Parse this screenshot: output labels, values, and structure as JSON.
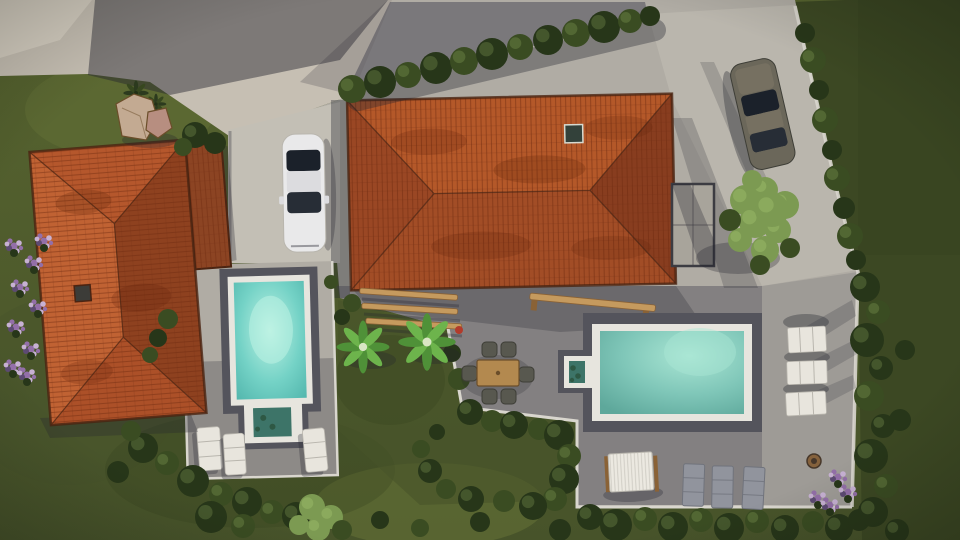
{
  "title": "aerial-render-villa-property",
  "scene_inventory": [
    "left villa with terracotta hip roof and chimney",
    "main villa with large terracotta hip roof and skylight",
    "white car on carport slab",
    "dark car parked near boundary wall",
    "small pool with step entry and three white loungers",
    "large pool with step entry, white loungers, gray loungers, canopy daybed",
    "pergola beams, outdoor dining table with six chairs, two palm trees",
    "hedge row, boundary wall with shrubs, lawns, rocks, purple flowers, fire pit"
  ],
  "palette": {
    "lawn_base": "#57642f",
    "lawn_dark": "#47532a",
    "lawn_light": "#6d7a3a",
    "lawn_shadow": "#36421f",
    "lawn_right": "#3c4823",
    "tree_dark": "#273619",
    "tree_mid": "#3a4c22",
    "tree_light": "#7c9a52",
    "tree_highlight": "#9ab968",
    "rock_ground": "#c6bfb3",
    "rock_lit": "#d8d1c4",
    "rock_big": "#c3aa92",
    "rock_small": "#b78e80",
    "pave_light": "#b0aca4",
    "pave_lit": "#c3bfb5",
    "curb_white": "#d9d6ce",
    "shadow": "#23242f",
    "terrace_shadow": "#3a3a4a",
    "roof_top": "#b45829",
    "roof_bottom": "#a24d26",
    "roof_west": "#9a4724",
    "roof_east": "#883d1f",
    "lroof_west": "#c06233",
    "lroof_north": "#b5572c",
    "lroof_south": "#ac5028",
    "lroof_east": "#8e411f",
    "annex_roof": "#8c4423",
    "roof_edge": "#4a2412",
    "roof_stain": "#5e2208",
    "tile_line": "#6e2a10",
    "chimney": "#3c3c38",
    "skylight": "#33413a",
    "skylight_frame": "#d7dad0",
    "glass_fill": "#9b97a0",
    "glass_inner": "#a8a49b",
    "glass_frame": "#3c3c42",
    "pool_frame": "#54545c",
    "coping": "#e7e5de",
    "water_glow": "#bdf2e3",
    "water_mid": "#74d2c6",
    "water_deep": "#4fb3aa",
    "water2_glow": "#aae6d4",
    "water2_mid": "#7fc6b8",
    "water2_deep": "#5ea89b",
    "step_water": "#3d7468",
    "plant_in_water": "#2e5844",
    "car_white": "#e9e9ea",
    "car_white_shade": "#dcdcdf",
    "glass_dark": "#1b212a",
    "glass_dark2": "#272d36",
    "car_dark_body": "#6b675a",
    "car_dark_hood": "#767061",
    "wood": "#c59a5e",
    "wood_dark": "#8a6236",
    "chair": "#58584f",
    "chair_edge": "#3e3e37",
    "table_wood": "#b3894f",
    "table_edge": "#6b4e2a",
    "lounger_white": "#e8e5dd",
    "lounger_line": "#b9b6ae",
    "lounger_gray": "#91949d",
    "lounger_gray_dark": "#70737c",
    "canopy_white": "#ece9e1",
    "flower_purple": "#936fa8",
    "flower_light": "#c7b1d3",
    "flower_deep": "#5d4a73",
    "firepit": "#85623d",
    "firepit_inner": "#46372a",
    "red_accent": "#b23b2b",
    "palm1": "#4f9138",
    "palm2": "#6db44c",
    "palm_center": "#d9e6c4",
    "agave1": "#2c3a1e",
    "agave2": "#37471f",
    "agave_center": "#233016"
  },
  "vegetation": {
    "hedge": [
      [
        352,
        89,
        14,
        "m"
      ],
      [
        380,
        82,
        16,
        "d"
      ],
      [
        408,
        75,
        13,
        "m"
      ],
      [
        436,
        68,
        16,
        "d"
      ],
      [
        464,
        61,
        14,
        "m"
      ],
      [
        492,
        54,
        16,
        "d"
      ],
      [
        520,
        47,
        13,
        "m"
      ],
      [
        548,
        40,
        15,
        "d"
      ],
      [
        576,
        33,
        14,
        "m"
      ],
      [
        604,
        27,
        16,
        "d"
      ],
      [
        630,
        21,
        12,
        "m"
      ],
      [
        650,
        16,
        10,
        "d"
      ]
    ],
    "wall_shrubs": [
      [
        805,
        33,
        10,
        "d"
      ],
      [
        813,
        60,
        13,
        "m"
      ],
      [
        819,
        90,
        10,
        "d"
      ],
      [
        825,
        120,
        13,
        "m"
      ],
      [
        832,
        150,
        10,
        "d"
      ],
      [
        837,
        178,
        13,
        "m"
      ],
      [
        844,
        208,
        11,
        "d"
      ],
      [
        850,
        236,
        13,
        "m"
      ],
      [
        856,
        260,
        10,
        "d"
      ]
    ],
    "right_band": [
      [
        865,
        287,
        15,
        "d"
      ],
      [
        878,
        312,
        12,
        "m"
      ],
      [
        867,
        340,
        17,
        "d"
      ],
      [
        881,
        368,
        12,
        "d"
      ],
      [
        869,
        396,
        15,
        "m"
      ],
      [
        883,
        426,
        12,
        "d"
      ],
      [
        871,
        456,
        17,
        "d"
      ],
      [
        886,
        486,
        12,
        "m"
      ],
      [
        873,
        512,
        15,
        "d"
      ],
      [
        897,
        531,
        12,
        "d"
      ],
      [
        905,
        350,
        10,
        "d"
      ],
      [
        900,
        420,
        11,
        "d"
      ]
    ],
    "deck_surround": [
      [
        143,
        448,
        15,
        "d"
      ],
      [
        167,
        463,
        12,
        "m"
      ],
      [
        193,
        481,
        16,
        "d"
      ],
      [
        221,
        494,
        12,
        "m"
      ],
      [
        247,
        502,
        15,
        "d"
      ],
      [
        272,
        512,
        12,
        "m"
      ],
      [
        296,
        516,
        14,
        "d"
      ],
      [
        131,
        431,
        10,
        "m"
      ],
      [
        118,
        472,
        11,
        "d"
      ],
      [
        211,
        517,
        16,
        "d"
      ],
      [
        243,
        526,
        12,
        "m"
      ],
      [
        158,
        338,
        9,
        "d"
      ],
      [
        168,
        319,
        10,
        "m"
      ],
      [
        150,
        355,
        8,
        "m"
      ]
    ],
    "bottom_left_tree": [
      [
        312,
        507,
        13,
        "l"
      ],
      [
        331,
        517,
        12,
        "l"
      ],
      [
        318,
        529,
        12,
        "l"
      ],
      [
        299,
        525,
        10,
        "l"
      ],
      [
        342,
        530,
        10,
        "m"
      ]
    ],
    "garden": [
      [
        352,
        303,
        9,
        "m"
      ],
      [
        342,
        317,
        8,
        "d"
      ],
      [
        331,
        282,
        7,
        "m"
      ],
      [
        452,
        353,
        9,
        "d"
      ],
      [
        459,
        379,
        11,
        "m"
      ],
      [
        470,
        412,
        13,
        "d"
      ],
      [
        492,
        421,
        11,
        "m"
      ],
      [
        514,
        425,
        14,
        "d"
      ],
      [
        539,
        429,
        11,
        "m"
      ],
      [
        559,
        435,
        15,
        "d"
      ],
      [
        569,
        456,
        12,
        "m"
      ],
      [
        564,
        479,
        15,
        "d"
      ],
      [
        555,
        499,
        12,
        "m"
      ],
      [
        533,
        506,
        14,
        "d"
      ],
      [
        504,
        501,
        11,
        "m"
      ],
      [
        471,
        499,
        13,
        "d"
      ],
      [
        446,
        489,
        10,
        "m"
      ],
      [
        430,
        471,
        12,
        "d"
      ],
      [
        421,
        449,
        9,
        "m"
      ],
      [
        437,
        432,
        8,
        "d"
      ]
    ],
    "bottom_band": [
      [
        590,
        517,
        13,
        "d"
      ],
      [
        616,
        525,
        16,
        "d"
      ],
      [
        645,
        519,
        12,
        "m"
      ],
      [
        673,
        527,
        15,
        "d"
      ],
      [
        701,
        520,
        12,
        "m"
      ],
      [
        729,
        528,
        15,
        "d"
      ],
      [
        757,
        521,
        12,
        "m"
      ],
      [
        785,
        529,
        14,
        "d"
      ],
      [
        813,
        522,
        11,
        "m"
      ],
      [
        839,
        528,
        14,
        "d"
      ],
      [
        859,
        520,
        11,
        "d"
      ],
      [
        560,
        530,
        11,
        "d"
      ],
      [
        480,
        522,
        10,
        "d"
      ],
      [
        420,
        528,
        9,
        "m"
      ],
      [
        380,
        520,
        9,
        "d"
      ]
    ],
    "light_tree": [
      [
        745,
        200,
        15,
        "l"
      ],
      [
        765,
        190,
        13,
        "l"
      ],
      [
        785,
        205,
        14,
        "l"
      ],
      [
        755,
        222,
        16,
        "l"
      ],
      [
        778,
        230,
        13,
        "l"
      ],
      [
        740,
        240,
        12,
        "l"
      ],
      [
        765,
        250,
        14,
        "l"
      ],
      [
        790,
        248,
        10,
        "m"
      ],
      [
        752,
        180,
        10,
        "l"
      ],
      [
        730,
        220,
        11,
        "m"
      ],
      [
        772,
        210,
        17,
        "l"
      ],
      [
        760,
        265,
        10,
        "m"
      ]
    ],
    "rock_bushes": [
      [
        195,
        135,
        13,
        "d"
      ],
      [
        215,
        143,
        11,
        "d"
      ],
      [
        183,
        147,
        9,
        "m"
      ]
    ]
  },
  "flowers": {
    "left_bank": [
      [
        14,
        246
      ],
      [
        34,
        263
      ],
      [
        20,
        287
      ],
      [
        38,
        307
      ],
      [
        16,
        327
      ],
      [
        31,
        349
      ],
      [
        13,
        367
      ],
      [
        44,
        241
      ],
      [
        27,
        375
      ]
    ],
    "terrace": [
      [
        838,
        477
      ],
      [
        848,
        492
      ],
      [
        818,
        498
      ],
      [
        830,
        505
      ]
    ]
  },
  "palms": [
    {
      "x": 363,
      "y": 347,
      "r": 23,
      "c": "palm"
    },
    {
      "x": 427,
      "y": 342,
      "r": 25,
      "c": "palm"
    },
    {
      "x": 136,
      "y": 93,
      "r": 11,
      "c": "agave"
    },
    {
      "x": 156,
      "y": 104,
      "r": 9,
      "c": "agave"
    }
  ]
}
